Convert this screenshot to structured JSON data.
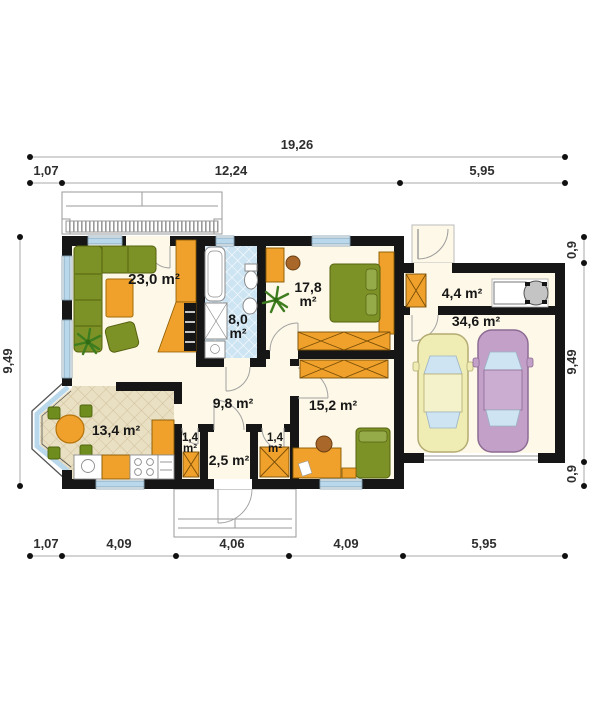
{
  "dimensions": {
    "top_total": "19,26",
    "top_segments": [
      "1,07",
      "12,24",
      "5,95"
    ],
    "bottom_segments": [
      "1,07",
      "4,09",
      "4,06",
      "4,09",
      "5,95"
    ],
    "left_height": "9,49",
    "right_segments": [
      "0,9",
      "9,49",
      "0,9"
    ]
  },
  "rooms": {
    "living": {
      "area": "23,0 m²"
    },
    "bathroom": {
      "area_value": "8,0",
      "area_unit": "m²"
    },
    "bedroom": {
      "area_value": "17,8",
      "area_unit": "m²"
    },
    "utility": {
      "area": "4,4 m²"
    },
    "garage": {
      "area": "34,6 m²"
    },
    "hall": {
      "area": "9,8 m²"
    },
    "kitchen": {
      "area": "13,4 m²"
    },
    "closet_left": {
      "area_value": "1,4",
      "area_unit": "m²"
    },
    "vestibule": {
      "area": "2,5 m²"
    },
    "closet_right": {
      "area_value": "1,4",
      "area_unit": "m²"
    },
    "room2": {
      "area": "15,2 m²"
    }
  },
  "colors": {
    "wall": "#161616",
    "floor_cream": "#fdf8e7",
    "accent_orange": "#f0a12c",
    "furniture_green": "#7d9226",
    "window_blue": "#b9d8eb",
    "bath_tile_blue": "#cde4f3",
    "kitchen_tile_tan": "#e9dfc3",
    "car_yellow": "#efecb4",
    "car_purple": "#c2a0c8"
  }
}
